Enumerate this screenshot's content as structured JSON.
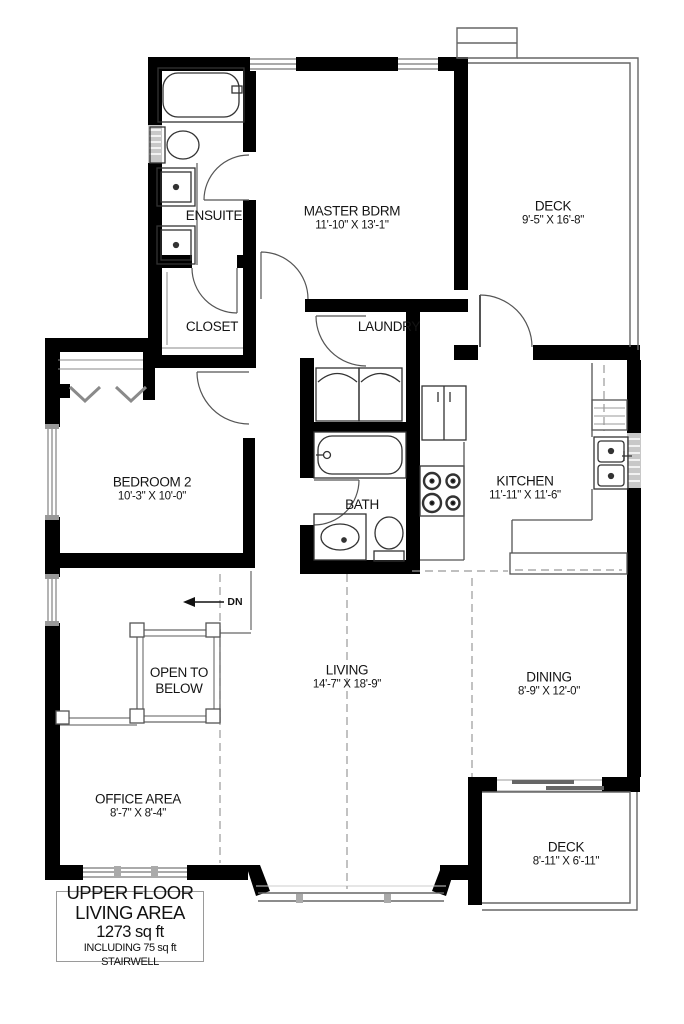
{
  "plan": {
    "rooms": {
      "ensuite": {
        "name": "ENSUITE"
      },
      "master": {
        "name": "MASTER BDRM",
        "dims": "11'-10\" X 13'-1\""
      },
      "deck_top": {
        "name": "DECK",
        "dims": "9'-5\" X 16'-8\""
      },
      "closet": {
        "name": "CLOSET"
      },
      "laundry": {
        "name": "LAUNDRY"
      },
      "bedroom2": {
        "name": "BEDROOM 2",
        "dims": "10'-3\" X 10'-0\""
      },
      "bath": {
        "name": "BATH"
      },
      "kitchen": {
        "name": "KITCHEN",
        "dims": "11'-11\" X 11'-6\""
      },
      "open_below": {
        "name": "OPEN TO BELOW"
      },
      "living": {
        "name": "LIVING",
        "dims": "14'-7\" X 18'-9\""
      },
      "dining": {
        "name": "DINING",
        "dims": "8'-9\" X 12'-0\""
      },
      "office": {
        "name": "OFFICE AREA",
        "dims": "8'-7\" X 8'-4\""
      },
      "deck_bottom": {
        "name": "DECK",
        "dims": "8'-11\" X 6'-11\""
      }
    },
    "stairs": {
      "direction_label": "DN"
    },
    "title_block": {
      "line1": "UPPER FLOOR",
      "line2": "LIVING AREA",
      "line3": "1273 sq ft",
      "line4": "INCLUDING 75 sq ft STAIRWELL"
    },
    "colors": {
      "wall": "#000000",
      "thin_line": "#666666",
      "window_fill": "#c8c8c8",
      "dashed_line": "#999999",
      "background": "#ffffff"
    }
  }
}
